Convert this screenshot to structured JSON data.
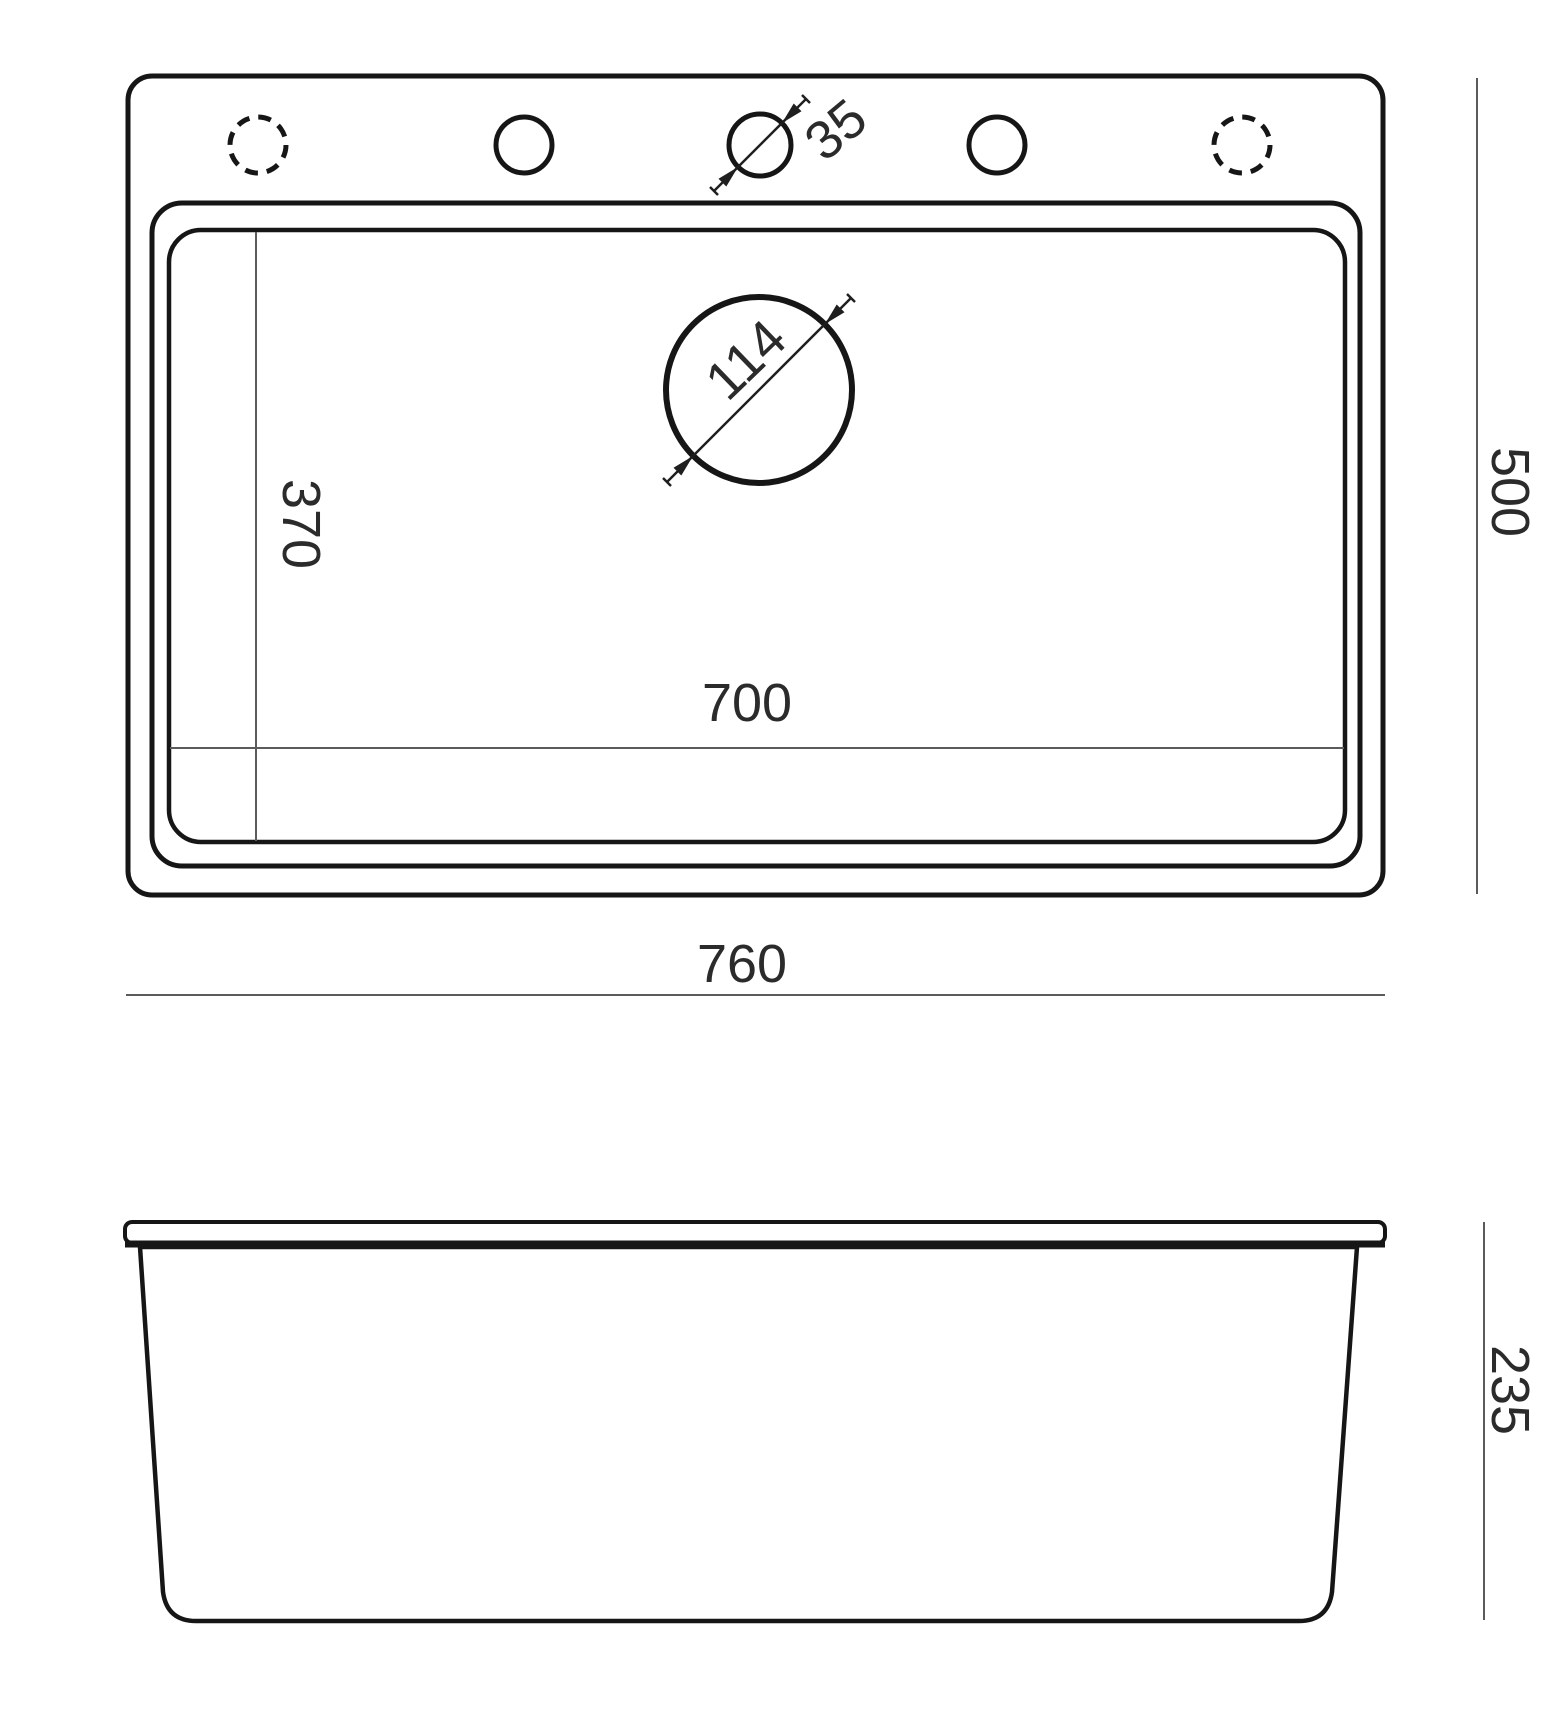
{
  "drawing": {
    "labels": {
      "overall_width": "760",
      "overall_depth": "500",
      "bowl_width": "700",
      "bowl_depth": "370",
      "side_height": "235",
      "drain_diameter": "114",
      "faucet_hole_diameter": "35"
    },
    "colors": {
      "ink": "#161616",
      "dimension_line": "#5b5b5b",
      "label_text": "#2b2b2b",
      "background": "#ffffff"
    }
  }
}
